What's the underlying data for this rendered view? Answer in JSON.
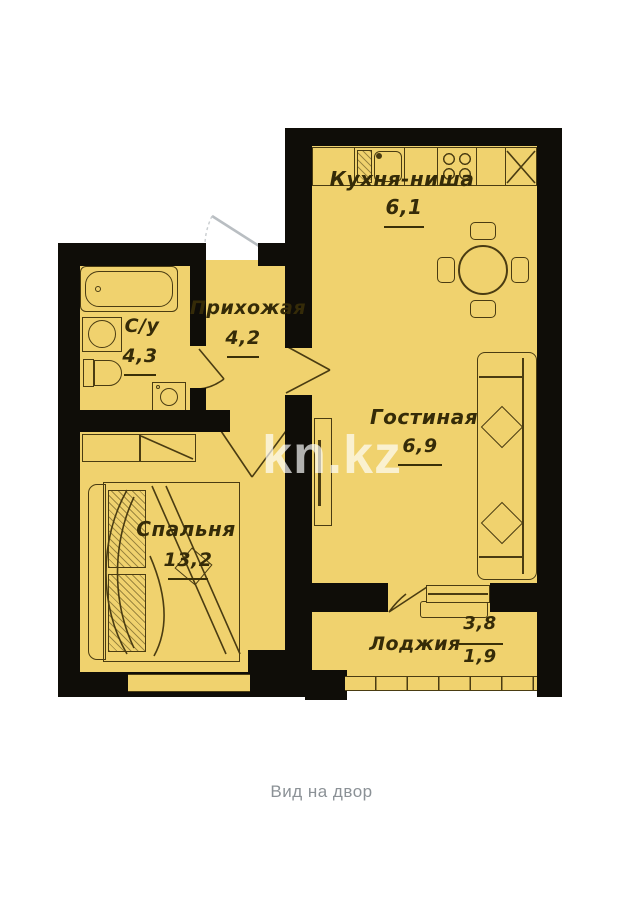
{
  "plan": {
    "rooms": {
      "kitchen": {
        "name": "Кухня-ниша",
        "area": "6,1"
      },
      "hallway": {
        "name": "Прихожая",
        "area": "4,2"
      },
      "bathroom": {
        "name": "С/у",
        "area": "4,3"
      },
      "living": {
        "name": "Гостиная",
        "area": "6,9"
      },
      "bedroom": {
        "name": "Спальня",
        "area": "13,2"
      },
      "loggia": {
        "name": "Лоджия",
        "area_total": "3,8",
        "area_reduced": "1,9"
      }
    },
    "caption": "Вид на двор",
    "watermark": "kn.kz",
    "colors": {
      "room_fill": "#f0d26e",
      "wall": "#0f0d08",
      "furniture_line": "#4a3c12",
      "caption_text": "#8b9196"
    }
  }
}
